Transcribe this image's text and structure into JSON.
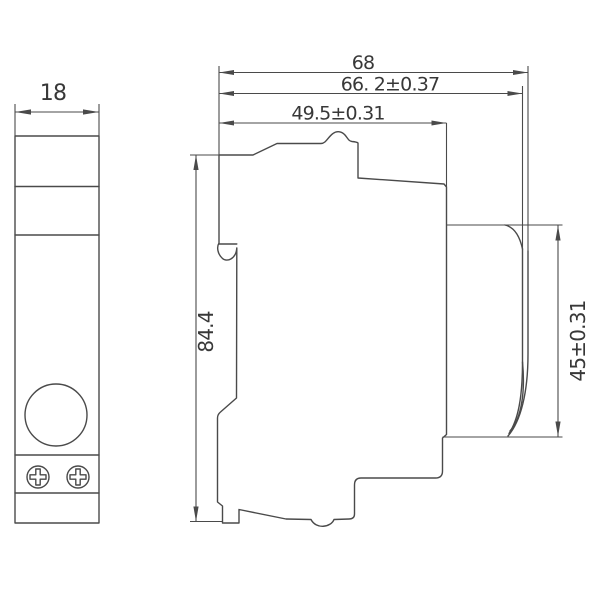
{
  "drawing": {
    "front_view": {
      "width_label": "18"
    },
    "side_view": {
      "overall_depth_label": "68",
      "depth_with_tolerance_label": "66. 2±0.37",
      "upper_depth_label": "49.5±0.31",
      "height_label": "84.4",
      "bezel_height_label": "45±0.31"
    },
    "colors": {
      "line": "#4a4a4a",
      "text": "#383838",
      "background": "#ffffff"
    }
  }
}
